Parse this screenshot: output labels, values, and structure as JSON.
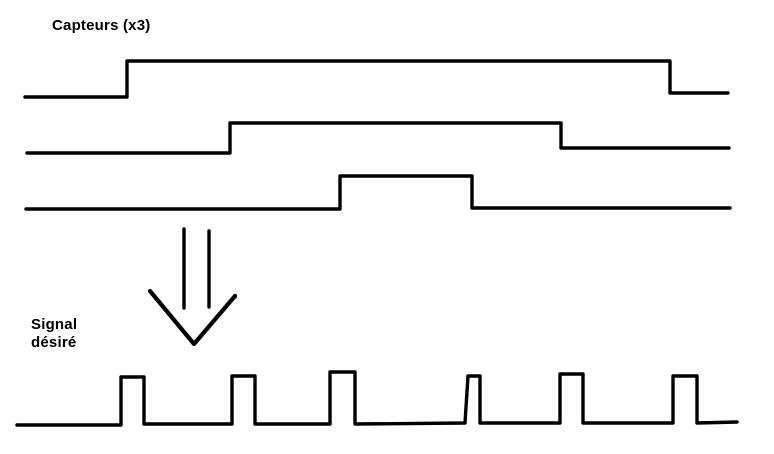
{
  "canvas": {
    "width": 774,
    "height": 454,
    "background": "#ffffff",
    "ink": "#000000"
  },
  "labels": {
    "capteurs": {
      "text": "Capteurs (x3)"
    },
    "signal_desire": {
      "line1": "Signal",
      "line2": "désiré"
    }
  },
  "diagram": {
    "stroke_width": 3.4,
    "arrow_head_stroke_width": 4.2,
    "waveforms": [
      {
        "name": "waveform-capteur-1",
        "points": [
          [
            25,
            97
          ],
          [
            127,
            97
          ],
          [
            127,
            61
          ],
          [
            670,
            61
          ],
          [
            670,
            93
          ],
          [
            728,
            93
          ]
        ]
      },
      {
        "name": "waveform-capteur-2",
        "points": [
          [
            27,
            153
          ],
          [
            230,
            153
          ],
          [
            230,
            123
          ],
          [
            561,
            123
          ],
          [
            561,
            148
          ],
          [
            729,
            148
          ]
        ]
      },
      {
        "name": "waveform-capteur-3",
        "points": [
          [
            26,
            209
          ],
          [
            340,
            209
          ],
          [
            340,
            176
          ],
          [
            472,
            176
          ],
          [
            472,
            208
          ],
          [
            730,
            208
          ]
        ]
      },
      {
        "name": "waveform-signal-desire",
        "points": [
          [
            17,
            425
          ],
          [
            121,
            425
          ],
          [
            121,
            377
          ],
          [
            144,
            377
          ],
          [
            144,
            424
          ],
          [
            232,
            424
          ],
          [
            232,
            376
          ],
          [
            255,
            376
          ],
          [
            255,
            424
          ],
          [
            330,
            424
          ],
          [
            330,
            372
          ],
          [
            355,
            372
          ],
          [
            355,
            424
          ],
          [
            465,
            423
          ],
          [
            468,
            376
          ],
          [
            480,
            376
          ],
          [
            480,
            423
          ],
          [
            560,
            423
          ],
          [
            560,
            374
          ],
          [
            583,
            374
          ],
          [
            583,
            423
          ],
          [
            673,
            423
          ],
          [
            673,
            376
          ],
          [
            697,
            376
          ],
          [
            697,
            423
          ],
          [
            737,
            422
          ]
        ]
      }
    ],
    "arrow": {
      "shafts": [
        [
          [
            184,
            229
          ],
          [
            184,
            308
          ]
        ],
        [
          [
            209,
            231
          ],
          [
            209,
            307
          ]
        ]
      ],
      "head": [
        [
          150,
          291
        ],
        [
          194,
          344
        ],
        [
          235,
          296
        ]
      ]
    }
  }
}
